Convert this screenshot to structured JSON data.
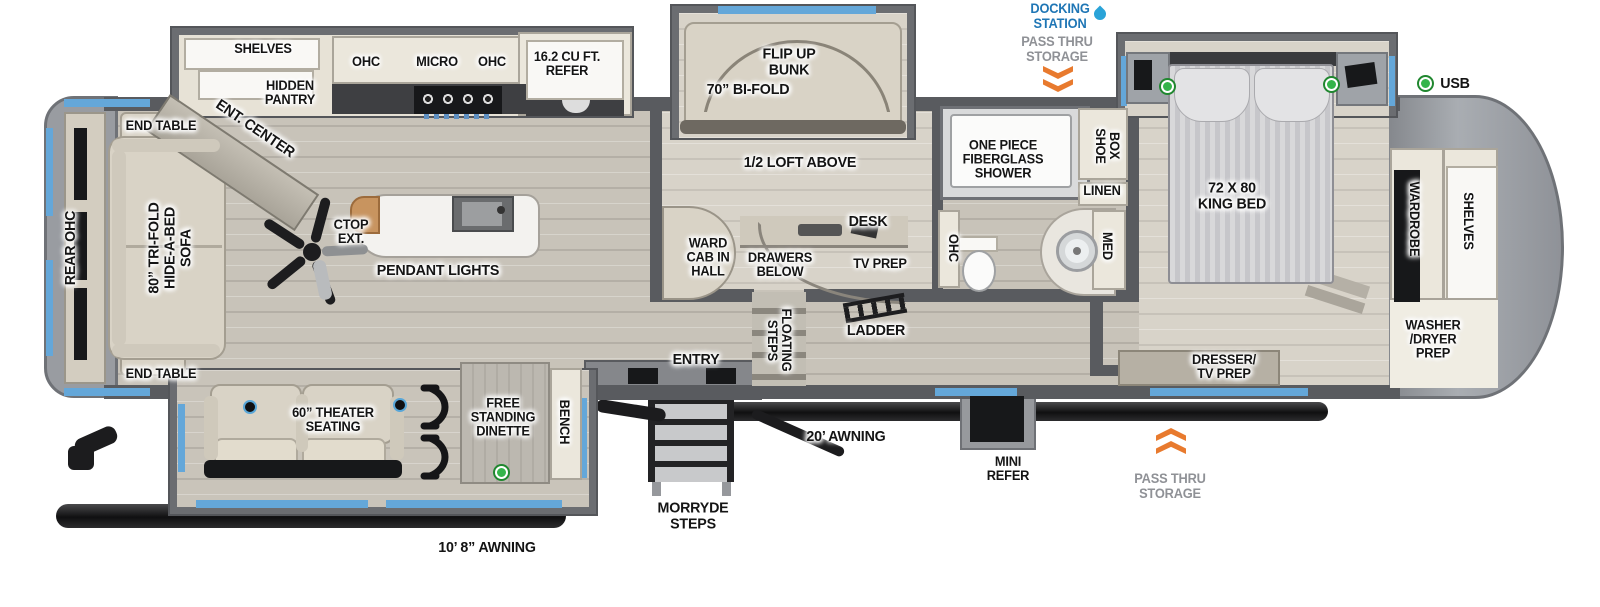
{
  "callouts": {
    "docking_station": "DOCKING\nSTATION",
    "pass_thru_storage_top": "PASS THRU\nSTORAGE",
    "pass_thru_storage_bottom": "PASS THRU\nSTORAGE",
    "usb": "USB"
  },
  "living_area": {
    "rear_ohc": "REAR OHC",
    "sofa": "80” TRI-FOLD\nHIDE-A-BED\nSOFA",
    "end_table_top": "END TABLE",
    "end_table_bottom": "END TABLE",
    "ent_center": "ENT. CENTER",
    "ctop_ext": "CTOP\nEXT.",
    "pendant_lights": "PENDANT LIGHTS",
    "theater_seating": "60” THEATER\nSEATING",
    "dinette": "FREE\nSTANDING\nDINETTE",
    "bench": "BENCH"
  },
  "kitchen": {
    "shelves": "SHELVES",
    "hidden_pantry": "HIDDEN\nPANTRY",
    "ohc_left": "OHC",
    "micro": "MICRO",
    "ohc_right": "OHC",
    "refer": "16.2 CU FT.\nREFER"
  },
  "bunk_room": {
    "flip_up_bunk": "FLIP UP\nBUNK",
    "bi_fold": "70” BI-FOLD",
    "loft": "1/2 LOFT ABOVE",
    "desk": "DESK",
    "ward_cab_in_hall": "WARD\nCAB IN\nHALL",
    "drawers_below": "DRAWERS\nBELOW",
    "tv_prep": "TV PREP",
    "floating_steps": "FLOATING\nSTEPS",
    "ladder": "LADDER"
  },
  "bathroom": {
    "shower": "ONE PIECE\nFIBERGLASS\nSHOWER",
    "ohc": "OHC",
    "shoe_box": "SHOE\nBOX",
    "linen": "LINEN",
    "med": "MED"
  },
  "bedroom": {
    "king_bed": "72 X 80\nKING BED",
    "dresser_tv_prep": "DRESSER/\nTV PREP",
    "wardrobe": "WARDROBE",
    "shelves": "SHELVES",
    "washer_dryer_prep": "WASHER\n/DRYER\nPREP"
  },
  "exterior": {
    "entry": "ENTRY",
    "morryde_steps": "MORRYDE\nSTEPS",
    "awning_main": "20’ AWNING",
    "awning_rear": "10’ 8” AWNING",
    "mini_refer": "MINI\nREFER"
  },
  "colors": {
    "accent_blue": "#64a7d9",
    "callout_blue": "#1f76b5",
    "callout_gray": "#8f9196",
    "arrow_orange": "#e87a2e",
    "usb_green": "#34b44a"
  }
}
